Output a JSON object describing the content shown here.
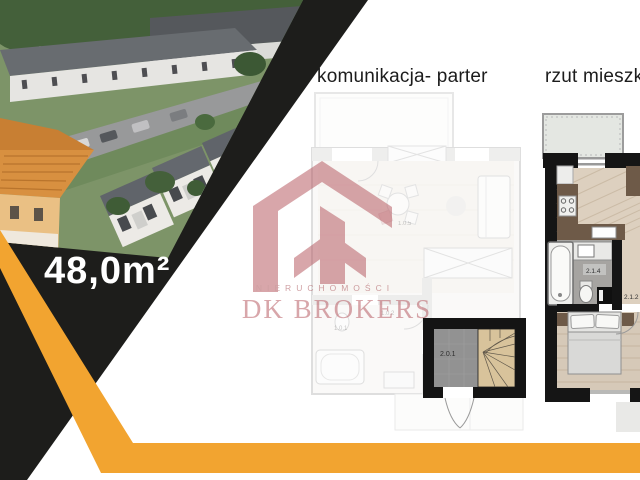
{
  "area": {
    "text": "48,0m²"
  },
  "titles": {
    "left": "komunikacja- parter",
    "right": "rzut mieszkania"
  },
  "watermark": {
    "tagline": "NIERUCHOMOŚCI",
    "brand": "DK BROKERS"
  },
  "plans": {
    "left": {
      "highlight_room": "2.0.1",
      "faint_rooms": {
        "living": "1.0.5",
        "hall": "1.0.2",
        "bath": "1.0.1"
      }
    },
    "right": {
      "bathroom": "2.1.4",
      "hall": "2.1.2"
    }
  },
  "colors": {
    "accent_orange": "#F2A430",
    "ribbon_black": "#1D1D1B",
    "logo_red": "#B5565E"
  }
}
